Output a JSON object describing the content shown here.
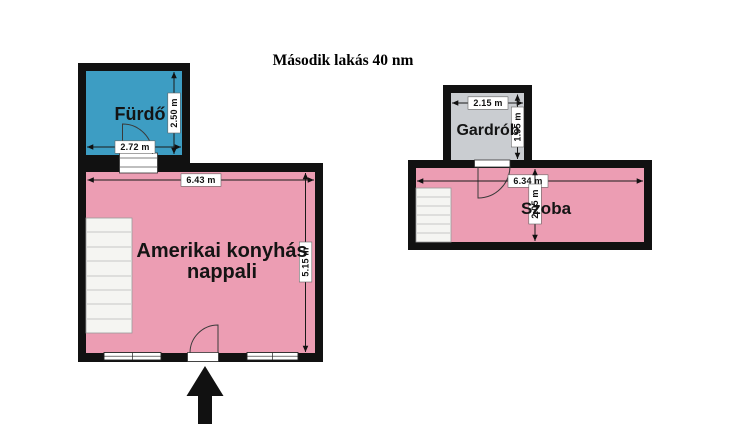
{
  "title": "Második lakás 40 nm",
  "colors": {
    "wall": "#111111",
    "bathroom_fill": "#3D9DC3",
    "living_fill": "#EC9DB3",
    "wardrobe_fill": "#CACDD1",
    "room_fill": "#EC9DB3",
    "stairs_fill": "#F5F5F2",
    "background": "#FFFFFF"
  },
  "rooms": {
    "bathroom": {
      "name": "Fürdő",
      "width": "2.72 m",
      "height": "2.50 m"
    },
    "living": {
      "name_line1": "Amerikai konyhás",
      "name_line2": "nappali",
      "width": "6.43 m",
      "height": "5.15 m"
    },
    "wardrobe": {
      "name": "Gardrób",
      "width": "2.15 m",
      "height": "1.95 m"
    },
    "room": {
      "name": "Szoba",
      "width": "6.34 m",
      "height": "2.05 m"
    }
  }
}
